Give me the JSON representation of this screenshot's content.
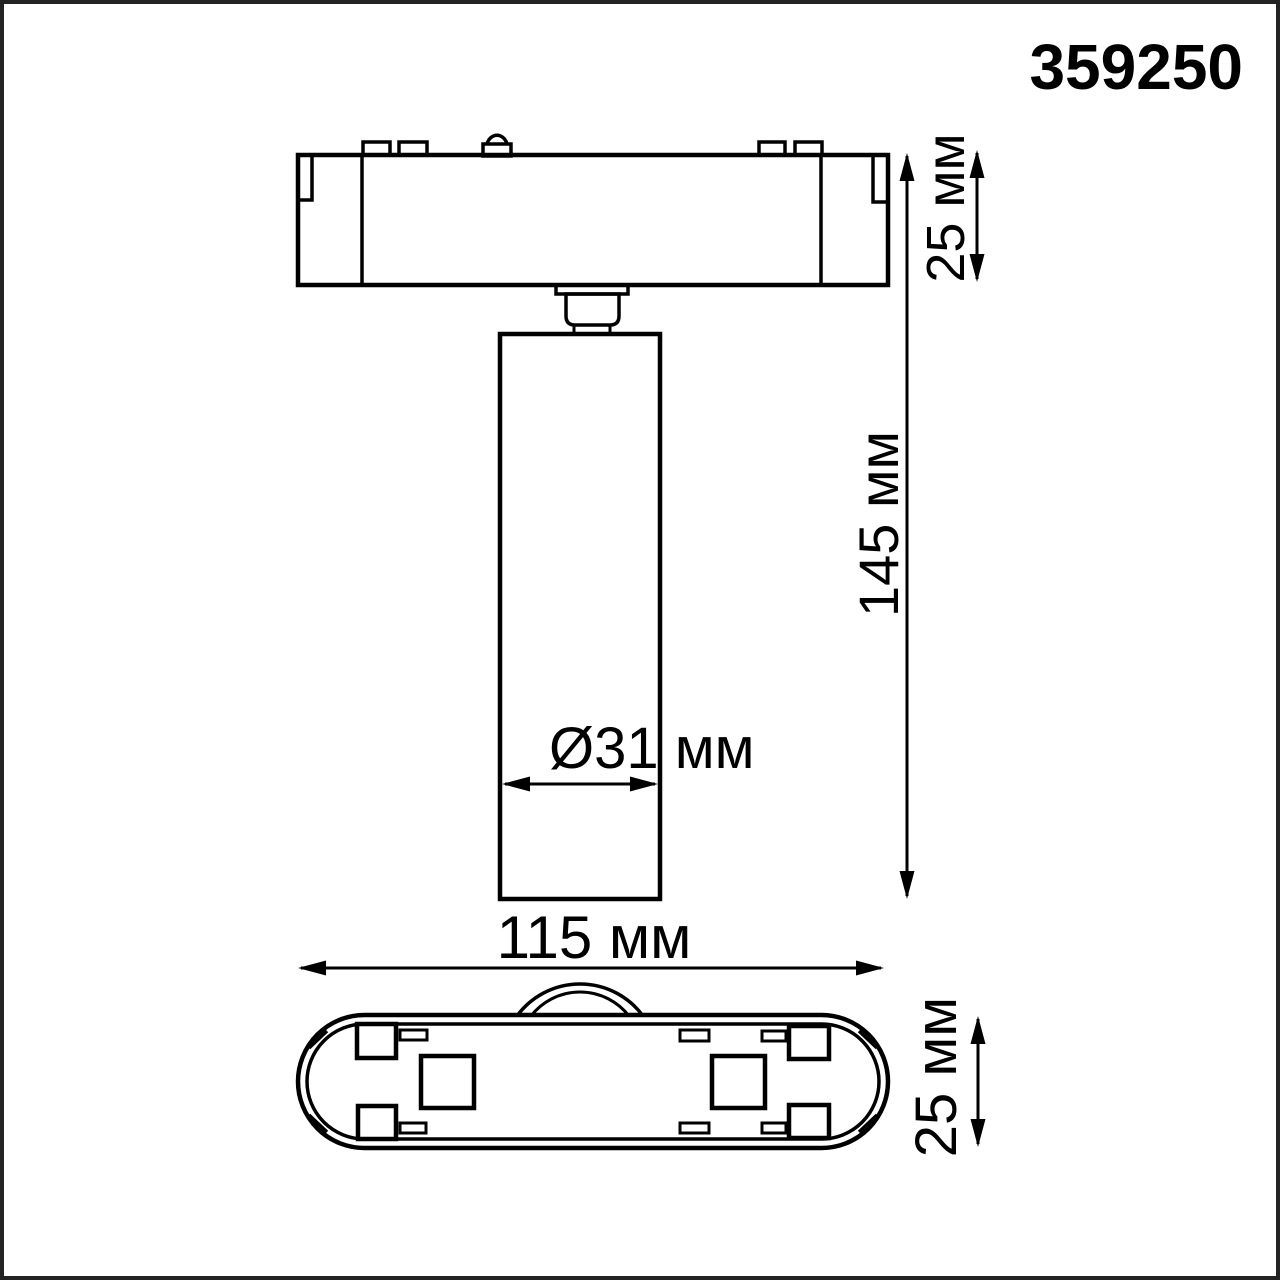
{
  "article_number": "359250",
  "views": {
    "side_view": "track light side profile",
    "bottom_view": "track adapter bottom plan"
  },
  "dimensions": {
    "track_base_height": "25 мм",
    "overall_height": "145 мм",
    "spot_diameter": "Ø31 мм",
    "base_width": "115 мм",
    "base_depth": "25 мм"
  },
  "colors": {
    "line": "#000000",
    "background": "#ffffff",
    "frame": "#232323"
  }
}
